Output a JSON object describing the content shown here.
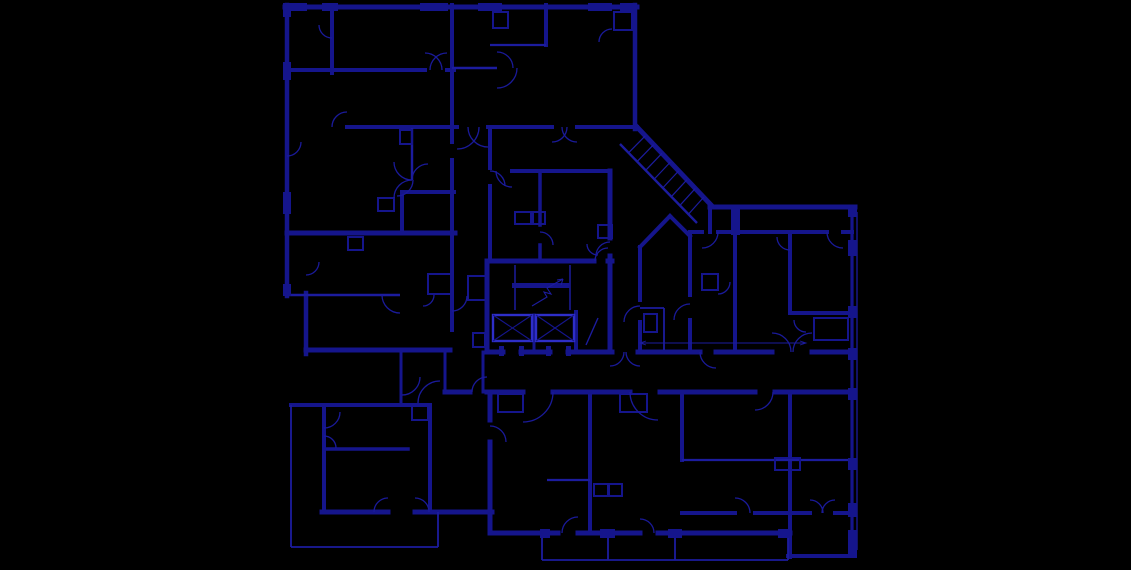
{
  "meta": {
    "drawing_type": "architectural-floor-plan",
    "canvas": {
      "width": 1131,
      "height": 570
    },
    "colors": {
      "background": "#000000",
      "wall": "#15158c",
      "thin": "#1c1c9e",
      "arc": "#1a1a9a",
      "bright": "#2e2ec8"
    }
  },
  "plan": {
    "walls": [
      [
        285,
        7,
        637,
        7,
        5
      ],
      [
        287,
        5,
        287,
        296,
        4.5
      ],
      [
        306,
        293,
        306,
        354,
        4.5
      ],
      [
        635,
        5,
        635,
        129,
        4.5
      ],
      [
        287,
        70,
        425,
        70,
        4
      ],
      [
        447,
        70,
        454,
        70,
        4
      ],
      [
        347,
        127,
        457,
        127,
        4
      ],
      [
        488,
        127,
        552,
        127,
        4
      ],
      [
        577,
        127,
        637,
        127,
        4
      ],
      [
        332,
        5,
        332,
        73,
        4
      ],
      [
        452,
        5,
        452,
        142,
        4
      ],
      [
        452,
        160,
        452,
        330,
        4
      ],
      [
        546,
        5,
        546,
        45,
        4
      ],
      [
        402,
        192,
        454,
        192,
        4
      ],
      [
        402,
        192,
        402,
        233,
        4
      ],
      [
        287,
        233,
        455,
        233,
        5
      ],
      [
        306,
        350,
        450,
        350,
        5
      ],
      [
        401,
        352,
        401,
        405,
        3
      ],
      [
        445,
        352,
        445,
        392,
        3
      ],
      [
        291,
        405,
        430,
        405,
        4
      ],
      [
        324,
        405,
        324,
        512,
        4
      ],
      [
        324,
        449,
        408,
        449,
        3.5
      ],
      [
        322,
        512,
        388,
        512,
        5
      ],
      [
        415,
        512,
        492,
        512,
        5
      ],
      [
        430,
        405,
        430,
        512,
        4
      ],
      [
        445,
        392,
        470,
        392,
        5
      ],
      [
        487,
        392,
        523,
        392,
        5
      ],
      [
        553,
        392,
        630,
        392,
        5
      ],
      [
        660,
        392,
        755,
        392,
        5
      ],
      [
        775,
        392,
        852,
        392,
        5
      ],
      [
        490,
        392,
        490,
        420,
        5
      ],
      [
        490,
        442,
        490,
        533,
        5
      ],
      [
        590,
        392,
        590,
        533,
        4
      ],
      [
        490,
        533,
        558,
        533,
        5
      ],
      [
        578,
        533,
        640,
        533,
        5
      ],
      [
        658,
        533,
        790,
        533,
        5
      ],
      [
        682,
        392,
        682,
        460,
        4
      ],
      [
        790,
        392,
        790,
        557,
        4
      ],
      [
        682,
        513,
        735,
        513,
        4
      ],
      [
        755,
        513,
        810,
        513,
        4
      ],
      [
        835,
        513,
        852,
        513,
        4
      ],
      [
        788,
        556,
        855,
        556,
        4
      ],
      [
        852,
        207,
        852,
        556,
        3.2
      ],
      [
        710,
        207,
        855,
        207,
        5
      ],
      [
        690,
        232,
        702,
        232,
        4
      ],
      [
        718,
        232,
        827,
        232,
        4
      ],
      [
        843,
        232,
        852,
        232,
        4
      ],
      [
        735,
        207,
        735,
        352,
        4
      ],
      [
        790,
        232,
        790,
        313,
        4
      ],
      [
        790,
        313,
        852,
        313,
        4
      ],
      [
        638,
        352,
        700,
        352,
        5
      ],
      [
        716,
        352,
        772,
        352,
        5
      ],
      [
        812,
        352,
        852,
        352,
        5
      ],
      [
        690,
        232,
        690,
        295,
        4
      ],
      [
        690,
        320,
        690,
        352,
        4
      ],
      [
        640,
        247,
        670,
        216,
        4
      ],
      [
        670,
        216,
        690,
        236,
        4
      ],
      [
        640,
        247,
        640,
        300,
        4
      ],
      [
        640,
        322,
        640,
        352,
        4
      ],
      [
        637,
        127,
        712,
        206,
        5
      ],
      [
        710,
        207,
        710,
        232,
        4
      ],
      [
        487,
        261,
        594,
        261,
        5
      ],
      [
        608,
        261,
        612,
        261,
        5
      ],
      [
        487,
        261,
        487,
        352,
        5
      ],
      [
        610,
        171,
        610,
        238,
        5
      ],
      [
        610,
        256,
        610,
        352,
        5
      ],
      [
        487,
        352,
        503,
        352,
        5
      ],
      [
        521,
        352,
        550,
        352,
        5
      ],
      [
        568,
        352,
        612,
        352,
        5
      ],
      [
        512,
        171,
        610,
        171,
        4
      ],
      [
        540,
        171,
        540,
        225,
        3.5
      ],
      [
        540,
        245,
        540,
        261,
        3.5
      ],
      [
        490,
        129,
        490,
        168,
        4
      ],
      [
        490,
        186,
        490,
        261,
        4
      ],
      [
        483,
        352,
        483,
        392,
        3
      ],
      [
        534,
        315,
        534,
        352,
        3
      ],
      [
        576,
        312,
        576,
        352,
        4
      ]
    ],
    "thin_walls": [
      [
        452,
        68,
        497,
        68,
        2.4
      ],
      [
        287,
        295,
        400,
        295,
        2.4
      ],
      [
        490,
        45,
        546,
        45,
        2.2
      ],
      [
        412,
        128,
        412,
        180,
        2.4
      ],
      [
        547,
        480,
        590,
        480,
        2.2
      ],
      [
        682,
        460,
        852,
        460,
        2.2
      ],
      [
        291,
        405,
        291,
        547,
        1.8
      ],
      [
        291,
        547,
        438,
        547,
        1.8
      ],
      [
        438,
        512,
        438,
        547,
        1.8
      ],
      [
        542,
        533,
        542,
        560,
        1.8
      ],
      [
        608,
        537,
        608,
        560,
        1.8
      ],
      [
        675,
        537,
        675,
        560,
        1.8
      ],
      [
        788,
        533,
        788,
        560,
        1.8
      ],
      [
        542,
        560,
        788,
        560,
        1.8
      ],
      [
        857,
        212,
        857,
        550,
        1.3
      ],
      [
        515,
        265,
        515,
        310,
        1.5
      ],
      [
        570,
        265,
        570,
        310,
        1.5
      ],
      [
        586,
        345,
        598,
        318,
        1.4
      ],
      [
        620,
        144,
        697,
        223,
        2.4
      ],
      [
        640,
        343,
        806,
        343,
        0.9
      ],
      [
        640,
        308,
        664,
        308,
        1.8
      ],
      [
        664,
        308,
        664,
        350,
        1.8
      ]
    ],
    "closet_boxes": [
      [
        493,
        12,
        15,
        16
      ],
      [
        614,
        12,
        18,
        18
      ],
      [
        378,
        198,
        16,
        13
      ],
      [
        400,
        130,
        12,
        14
      ],
      [
        348,
        237,
        15,
        13
      ],
      [
        515,
        212,
        16,
        12
      ],
      [
        533,
        212,
        12,
        12
      ],
      [
        598,
        225,
        14,
        13
      ],
      [
        428,
        274,
        24,
        20
      ],
      [
        468,
        276,
        20,
        24
      ],
      [
        473,
        333,
        12,
        14
      ],
      [
        412,
        406,
        16,
        14
      ],
      [
        498,
        394,
        25,
        18
      ],
      [
        620,
        394,
        27,
        18
      ],
      [
        594,
        484,
        14,
        12
      ],
      [
        609,
        484,
        13,
        12
      ],
      [
        702,
        274,
        16,
        16
      ],
      [
        814,
        318,
        34,
        22
      ],
      [
        775,
        458,
        25,
        12
      ],
      [
        644,
        314,
        13,
        18
      ]
    ],
    "pillars": [
      [
        285,
        3,
        22,
        8
      ],
      [
        322,
        3,
        16,
        8
      ],
      [
        420,
        3,
        28,
        8
      ],
      [
        478,
        3,
        24,
        8
      ],
      [
        588,
        3,
        24,
        8
      ],
      [
        620,
        3,
        17,
        8
      ],
      [
        283,
        3,
        8,
        14
      ],
      [
        283,
        62,
        8,
        18
      ],
      [
        283,
        192,
        8,
        22
      ],
      [
        283,
        284,
        8,
        12
      ],
      [
        848,
        205,
        9,
        12
      ],
      [
        848,
        240,
        9,
        16
      ],
      [
        848,
        306,
        9,
        12
      ],
      [
        848,
        348,
        9,
        12
      ],
      [
        848,
        388,
        9,
        12
      ],
      [
        848,
        458,
        9,
        12
      ],
      [
        848,
        503,
        9,
        14
      ],
      [
        848,
        530,
        9,
        28
      ],
      [
        540,
        529,
        10,
        9
      ],
      [
        600,
        529,
        15,
        9
      ],
      [
        668,
        529,
        14,
        9
      ],
      [
        778,
        529,
        12,
        9
      ],
      [
        731,
        205,
        9,
        30
      ],
      [
        499,
        346,
        5,
        10
      ],
      [
        519,
        346,
        5,
        10
      ],
      [
        546,
        346,
        5,
        10
      ],
      [
        566,
        346,
        5,
        10
      ],
      [
        512,
        283,
        58,
        5
      ]
    ],
    "door_arcs": [
      [
        287,
        142,
        14,
        0,
        90
      ],
      [
        306,
        262,
        13,
        0,
        90
      ],
      [
        332,
        25,
        13,
        90,
        180
      ],
      [
        347,
        127,
        15,
        180,
        270
      ],
      [
        412,
        162,
        18,
        90,
        180
      ],
      [
        412,
        198,
        18,
        180,
        270
      ],
      [
        397,
        180,
        16,
        0,
        90
      ],
      [
        428,
        180,
        16,
        180,
        270
      ],
      [
        425,
        70,
        17,
        270,
        360
      ],
      [
        447,
        70,
        17,
        180,
        270
      ],
      [
        497,
        68,
        16,
        270,
        360
      ],
      [
        497,
        68,
        20,
        0,
        90
      ],
      [
        612,
        42,
        13,
        180,
        270
      ],
      [
        552,
        127,
        15,
        0,
        90
      ],
      [
        577,
        127,
        15,
        90,
        180
      ],
      [
        457,
        127,
        22,
        0,
        90
      ],
      [
        488,
        127,
        20,
        90,
        180
      ],
      [
        512,
        171,
        16,
        90,
        180
      ],
      [
        490,
        186,
        15,
        270,
        360
      ],
      [
        540,
        245,
        13,
        270,
        360
      ],
      [
        610,
        256,
        14,
        180,
        270
      ],
      [
        598,
        244,
        11,
        90,
        180
      ],
      [
        608,
        261,
        13,
        180,
        270
      ],
      [
        400,
        295,
        18,
        90,
        180
      ],
      [
        423,
        295,
        11,
        0,
        90
      ],
      [
        452,
        296,
        15,
        0,
        90
      ],
      [
        402,
        377,
        18,
        0,
        90
      ],
      [
        440,
        403,
        22,
        180,
        270
      ],
      [
        324,
        412,
        16,
        0,
        90
      ],
      [
        324,
        448,
        12,
        270,
        360
      ],
      [
        388,
        512,
        14,
        180,
        270
      ],
      [
        415,
        512,
        14,
        270,
        360
      ],
      [
        487,
        392,
        15,
        180,
        270
      ],
      [
        523,
        392,
        30,
        0,
        90
      ],
      [
        658,
        392,
        28,
        90,
        180
      ],
      [
        578,
        533,
        16,
        180,
        270
      ],
      [
        640,
        533,
        14,
        270,
        360
      ],
      [
        610,
        352,
        14,
        0,
        90
      ],
      [
        640,
        352,
        14,
        90,
        180
      ],
      [
        640,
        322,
        16,
        180,
        270
      ],
      [
        690,
        320,
        16,
        180,
        270
      ],
      [
        702,
        232,
        16,
        0,
        90
      ],
      [
        843,
        232,
        16,
        90,
        180
      ],
      [
        790,
        237,
        13,
        90,
        180
      ],
      [
        718,
        282,
        12,
        0,
        90
      ],
      [
        716,
        352,
        16,
        90,
        180
      ],
      [
        772,
        352,
        19,
        270,
        360
      ],
      [
        812,
        352,
        19,
        180,
        270
      ],
      [
        806,
        320,
        12,
        90,
        180
      ],
      [
        735,
        513,
        15,
        270,
        360
      ],
      [
        810,
        513,
        13,
        270,
        360
      ],
      [
        835,
        513,
        13,
        180,
        270
      ],
      [
        755,
        392,
        18,
        0,
        90
      ],
      [
        490,
        442,
        16,
        270,
        360
      ]
    ],
    "elevators": [
      [
        493,
        315,
        39,
        26
      ],
      [
        536,
        315,
        38,
        26
      ]
    ],
    "stair_hatch": {
      "edge1": [
        637,
        127,
        712,
        206
      ],
      "edge2": [
        620,
        144,
        697,
        223
      ],
      "ticks": 8
    },
    "polylines": [
      {
        "pts": [
          [
            532,
            306
          ],
          [
            547,
            297
          ],
          [
            544,
            292
          ],
          [
            551,
            294
          ],
          [
            547,
            288
          ],
          [
            563,
            279
          ]
        ],
        "w": 1.1
      },
      {
        "pts": [
          [
            563,
            279
          ],
          [
            557,
            280
          ]
        ],
        "w": 1.1
      },
      {
        "pts": [
          [
            563,
            279
          ],
          [
            561,
            285
          ]
        ],
        "w": 1.1
      },
      {
        "pts": [
          [
            646,
            341
          ],
          [
            640,
            343
          ],
          [
            646,
            345
          ]
        ],
        "w": 0.9
      },
      {
        "pts": [
          [
            800,
            341
          ],
          [
            806,
            343
          ],
          [
            800,
            345
          ]
        ],
        "w": 0.9
      }
    ]
  }
}
